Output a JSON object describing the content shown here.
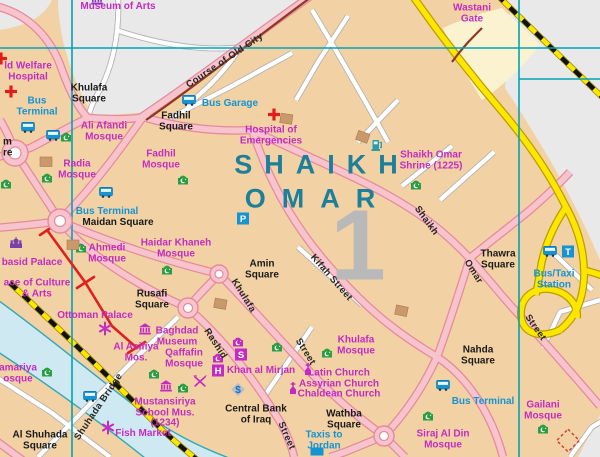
{
  "district": {
    "line1": "SHAIKH",
    "line2": "OMAR",
    "number": "1"
  },
  "colors": {
    "land": "#f2d2a4",
    "built_other": "#e9e9e9",
    "river": "#cfe9f3",
    "river_bank": "#2fa8b8",
    "road_major": "#f7c3cc",
    "road_major_casing": "#e58a9b",
    "motorway": "#ffe600",
    "railway": "#ffe600",
    "grid": "#00a3b4",
    "poi_label": "#c32cc3",
    "transport_label": "#1593d2",
    "square_label": "#1a1a1a",
    "district_label": "#1d7f99",
    "wall_remains": "#e02020",
    "old_wall_course": "#8b3a20",
    "mosque_icon": "#2b9e43"
  },
  "labels": {
    "squares": [
      {
        "t": "Khulafa\nSquare",
        "x": 89,
        "y": 94
      },
      {
        "t": "Fadhil\nSquare",
        "x": 176,
        "y": 122
      },
      {
        "t": "Maidan Square",
        "x": 118,
        "y": 223
      },
      {
        "t": "Amin\nSquare",
        "x": 262,
        "y": 270
      },
      {
        "t": "Rusafi\nSquare",
        "x": 152,
        "y": 300
      },
      {
        "t": "Thawra\nSquare",
        "x": 498,
        "y": 260
      },
      {
        "t": "Nahda\nSquare",
        "x": 478,
        "y": 356
      },
      {
        "t": "Wathba\nSquare",
        "x": 344,
        "y": 420
      },
      {
        "t": "Al Shuhada\nSquare",
        "x": 40,
        "y": 441
      },
      {
        "t": "Central Bank\nof Iraq",
        "x": 256,
        "y": 415
      },
      {
        "t": "m\nre",
        "x": 3,
        "y": 148,
        "a": "l"
      }
    ],
    "pois": [
      {
        "t": "Museum of Arts",
        "x": 118,
        "y": 7
      },
      {
        "t": "Wastani\nGate",
        "x": 472,
        "y": 14
      },
      {
        "t": "ld Welfare\nHospital",
        "x": 28,
        "y": 72
      },
      {
        "t": "Ali Afandi\nMosque",
        "x": 104,
        "y": 132
      },
      {
        "t": "Radia\nMosque",
        "x": 77,
        "y": 170
      },
      {
        "t": "Fadhil\nMosque",
        "x": 161,
        "y": 160
      },
      {
        "t": "Hospital of\nEmergencies",
        "x": 271,
        "y": 136
      },
      {
        "t": "Shaikh Omar\nShrine (1225)",
        "x": 431,
        "y": 161
      },
      {
        "t": "Ahmedi\nMosque",
        "x": 107,
        "y": 254
      },
      {
        "t": "Haidar Khaneh\nMosque",
        "x": 176,
        "y": 249
      },
      {
        "t": "basid Palace",
        "x": 32,
        "y": 263,
        "a": "l2"
      },
      {
        "t": "ace of Culture\n& Arts",
        "x": 37,
        "y": 289,
        "a": "l2"
      },
      {
        "t": "Ottoman Palace",
        "x": 95,
        "y": 316
      },
      {
        "t": "Al Asifiya\nMos.",
        "x": 136,
        "y": 353
      },
      {
        "t": "Baghdad\nMuseum",
        "x": 177,
        "y": 337
      },
      {
        "t": "Qaffafin\nMosque",
        "x": 184,
        "y": 359
      },
      {
        "t": "Khan al Mirjan",
        "x": 261,
        "y": 371
      },
      {
        "t": "Khulafa\nMosque",
        "x": 356,
        "y": 346
      },
      {
        "t": "Latin Church\nAssyrian Church\nChaldean Church",
        "x": 339,
        "y": 384
      },
      {
        "t": "Mustansiriya\nSchool Mus.\n(1234)",
        "x": 165,
        "y": 413
      },
      {
        "t": "amariya\nosque",
        "x": 18,
        "y": 374,
        "a": "l2"
      },
      {
        "t": "Fish Market",
        "x": 143,
        "y": 434
      },
      {
        "t": "Siraj Al Din\nMosque",
        "x": 443,
        "y": 440
      },
      {
        "t": "Gailani\nMosque",
        "x": 543,
        "y": 411
      }
    ],
    "transport": [
      {
        "t": "Bus\nTerminal",
        "x": 37,
        "y": 107
      },
      {
        "t": "Bus Garage",
        "x": 230,
        "y": 104
      },
      {
        "t": "Bus Terminal",
        "x": 107,
        "y": 212
      },
      {
        "t": "Bus/Taxi\nStation",
        "x": 554,
        "y": 280
      },
      {
        "t": "Bus Terminal",
        "x": 483,
        "y": 402
      },
      {
        "t": "Taxis to\nJordan",
        "x": 324,
        "y": 441
      }
    ],
    "streets": [
      {
        "t": "Course of Old City",
        "x": 225,
        "y": 61,
        "r": -34
      },
      {
        "t": "Kifah Street",
        "x": 331,
        "y": 278,
        "r": 49
      },
      {
        "t": "Khulafa",
        "x": 243,
        "y": 296,
        "r": 58
      },
      {
        "t": "Street",
        "x": 305,
        "y": 352,
        "r": 58
      },
      {
        "t": "Rashid",
        "x": 215,
        "y": 344,
        "r": 57
      },
      {
        "t": "Street",
        "x": 286,
        "y": 436,
        "r": 66
      },
      {
        "t": "Shaikh",
        "x": 426,
        "y": 221,
        "r": 54
      },
      {
        "t": "Omar",
        "x": 473,
        "y": 272,
        "r": 58
      },
      {
        "t": "Street",
        "x": 535,
        "y": 328,
        "r": 55
      },
      {
        "t": "Shuhada Bridge",
        "x": 99,
        "y": 407,
        "r": -56
      }
    ]
  },
  "icons": [
    {
      "type": "mosque",
      "x": 66,
      "y": 139
    },
    {
      "type": "mosque",
      "x": 47,
      "y": 180
    },
    {
      "type": "mosque",
      "x": 6,
      "y": 186
    },
    {
      "type": "mosque",
      "x": 183,
      "y": 182
    },
    {
      "type": "mosque",
      "x": 81,
      "y": 250
    },
    {
      "type": "mosque",
      "x": 167,
      "y": 272
    },
    {
      "type": "mosque",
      "x": 416,
      "y": 187
    },
    {
      "type": "mosque",
      "x": 154,
      "y": 376
    },
    {
      "type": "mosque",
      "x": 183,
      "y": 390
    },
    {
      "type": "mosque",
      "x": 277,
      "y": 349
    },
    {
      "type": "mosque",
      "x": 327,
      "y": 355
    },
    {
      "type": "mosque",
      "x": 428,
      "y": 418
    },
    {
      "type": "mosque",
      "x": 543,
      "y": 431
    },
    {
      "type": "mosque",
      "x": 47,
      "y": 374
    },
    {
      "type": "mosque-m",
      "x": 238,
      "y": 344
    },
    {
      "type": "mosque-m",
      "x": 218,
      "y": 360
    },
    {
      "type": "bus",
      "x": 28,
      "y": 130
    },
    {
      "type": "bus",
      "x": 53,
      "y": 138
    },
    {
      "type": "bus",
      "x": 106,
      "y": 195
    },
    {
      "type": "bus",
      "x": 189,
      "y": 103
    },
    {
      "type": "bus",
      "x": 90,
      "y": 399
    },
    {
      "type": "bus",
      "x": 443,
      "y": 388
    },
    {
      "type": "bus",
      "x": 550,
      "y": 254
    },
    {
      "type": "taxi",
      "x": 568,
      "y": 254
    },
    {
      "type": "parking",
      "x": 243,
      "y": 221
    },
    {
      "type": "hotel",
      "x": 218,
      "y": 373
    },
    {
      "type": "souq",
      "x": 241,
      "y": 357
    },
    {
      "type": "bank",
      "x": 238,
      "y": 392
    },
    {
      "type": "restaurant",
      "x": 200,
      "y": 384
    },
    {
      "type": "church",
      "x": 308,
      "y": 372
    },
    {
      "type": "church",
      "x": 293,
      "y": 391
    },
    {
      "type": "redcross",
      "x": 11,
      "y": 94
    },
    {
      "type": "redcross",
      "x": 274,
      "y": 117
    },
    {
      "type": "redcross",
      "x": 1,
      "y": 61
    },
    {
      "type": "museum",
      "x": 145,
      "y": 332
    },
    {
      "type": "museum",
      "x": 166,
      "y": 389
    },
    {
      "type": "museum-v",
      "x": 97,
      "y": 2
    },
    {
      "type": "palace",
      "x": 16,
      "y": 245
    },
    {
      "type": "asterisk",
      "x": 105,
      "y": 331
    },
    {
      "type": "asterisk",
      "x": 108,
      "y": 430
    },
    {
      "type": "fuel",
      "x": 377,
      "y": 148
    },
    {
      "type": "bldg",
      "x": 286,
      "y": 121,
      "r": 8
    },
    {
      "type": "bldg",
      "x": 362,
      "y": 139,
      "r": 20
    },
    {
      "type": "bldg",
      "x": 401,
      "y": 313,
      "r": 12
    },
    {
      "type": "bldg",
      "x": 73,
      "y": 247,
      "r": 0
    },
    {
      "type": "bldg",
      "x": 46,
      "y": 164,
      "r": 0
    },
    {
      "type": "bldg",
      "x": 220,
      "y": 306,
      "r": 10
    },
    {
      "type": "site",
      "x": 568,
      "y": 443
    },
    {
      "type": "bluerect",
      "x": 317,
      "y": 454
    }
  ]
}
